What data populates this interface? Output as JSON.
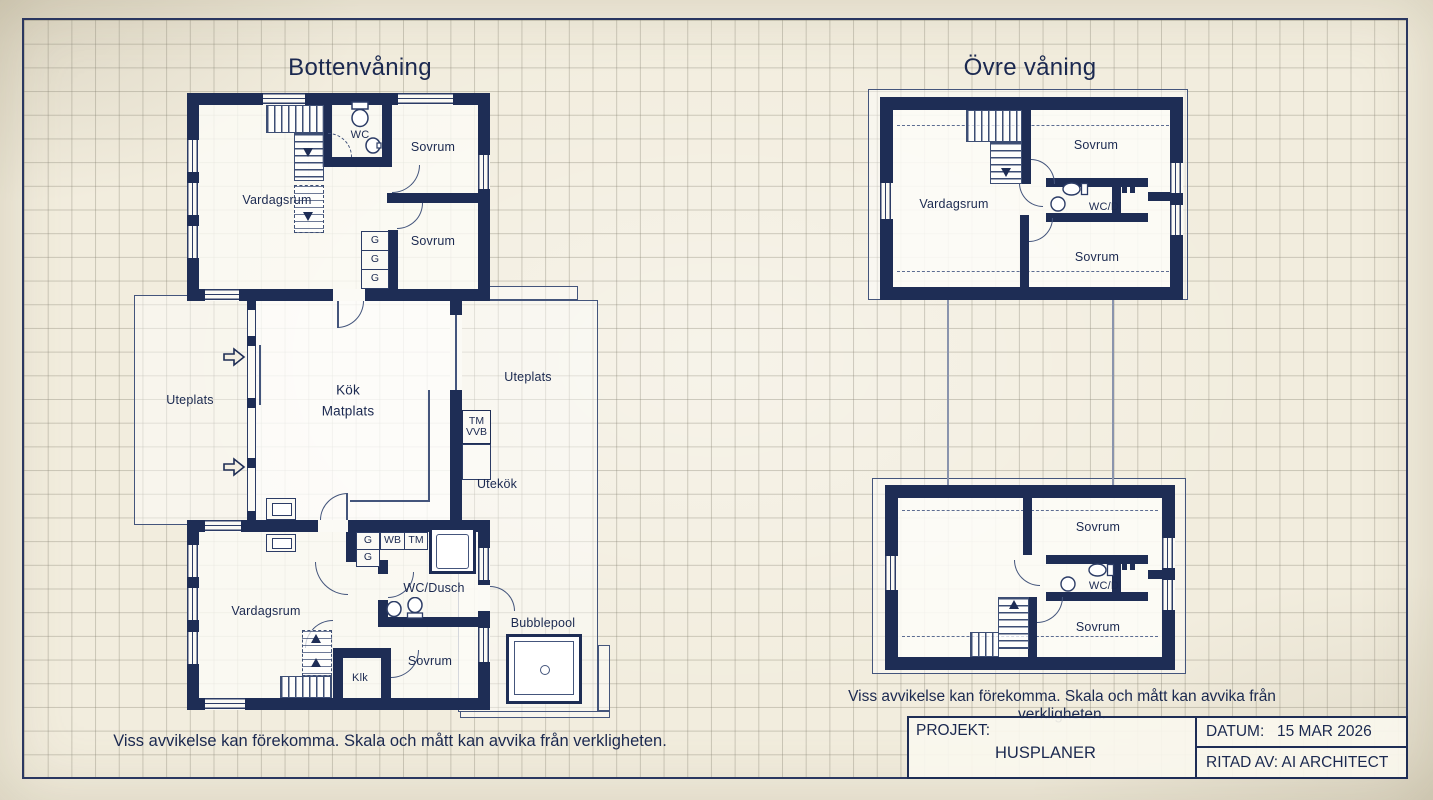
{
  "sheet": {
    "ground_plan_title": "Bottenvåning",
    "upper_plan_title": "Övre våning",
    "disclaimer": "Viss avvikelse kan förekomma. Skala och mått kan avvika från verkligheten."
  },
  "rooms": {
    "vardagsrum": "Vardagsrum",
    "sovrum": "Sovrum",
    "wc": "WC",
    "wc_dusch": "WC/Dusch",
    "wc_d": "WC/D",
    "kok": "Kök",
    "matplats": "Matplats",
    "uteplats": "Uteplats",
    "utekok": "Utekök",
    "klk": "Klk",
    "bubblepool": "Bubblepool"
  },
  "fixtures": {
    "g": "G",
    "wb": "WB",
    "tm": "TM",
    "vvb": "VVB"
  },
  "title_block": {
    "projekt_label": "PROJEKT:",
    "projekt_value": "HUSPLANER",
    "datum_label": "DATUM:",
    "datum_value": "15 MAR 2026",
    "ritad_av": "RITAD AV: AI ARCHITECT"
  },
  "colors": {
    "wall": "#1e2d55",
    "line": "#44557c",
    "text": "#1b2950",
    "paper": "#f2edde"
  }
}
